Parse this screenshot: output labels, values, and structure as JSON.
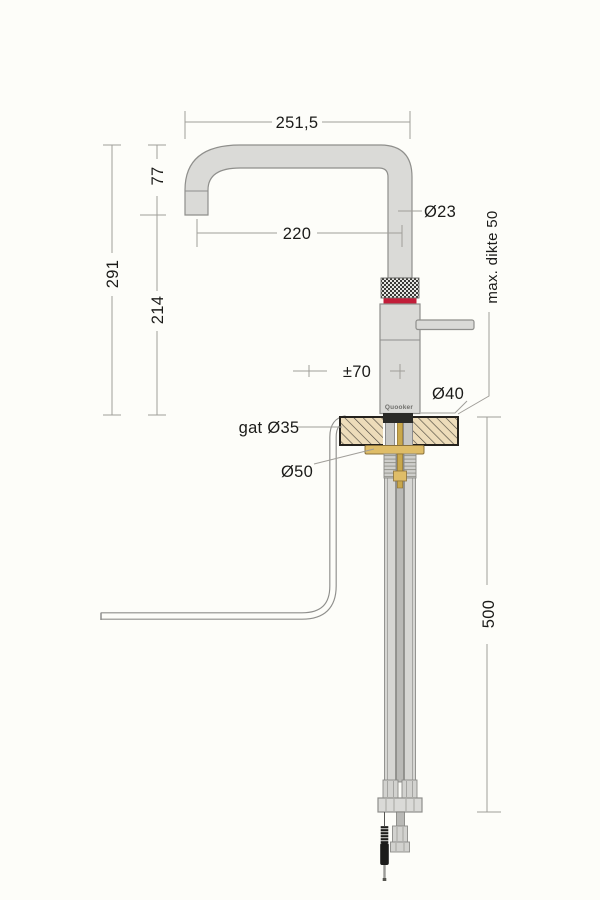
{
  "meta": {
    "description_visible": false
  },
  "brand": {
    "logo": "Quooker"
  },
  "labels": {
    "spout_width": "251,5",
    "spout_drop": "77",
    "total_height": "291",
    "base_to_spout": "214",
    "spout_reach": "220",
    "spout_diameter": "Ø23",
    "max_thickness": "max. dikte 50",
    "handle_offset": "±70",
    "base_diameter": "Ø40",
    "hole_diameter": "gat Ø35",
    "washer_diameter": "Ø50",
    "clearance_below": "500"
  },
  "colors": {
    "background": "#fdfdf9",
    "faucet_fill": "#dadad7",
    "faucet_stroke": "#8f8f8c",
    "accent_red": "#c21d39",
    "brass": "#dfbd68",
    "brass_dark": "#c9a84c",
    "counter_fill": "#eddcba",
    "hatch_line": "#4e4a40",
    "gasket_black": "#2b2b28",
    "dim_line": "#a09e99",
    "text": "#1b1b19"
  }
}
